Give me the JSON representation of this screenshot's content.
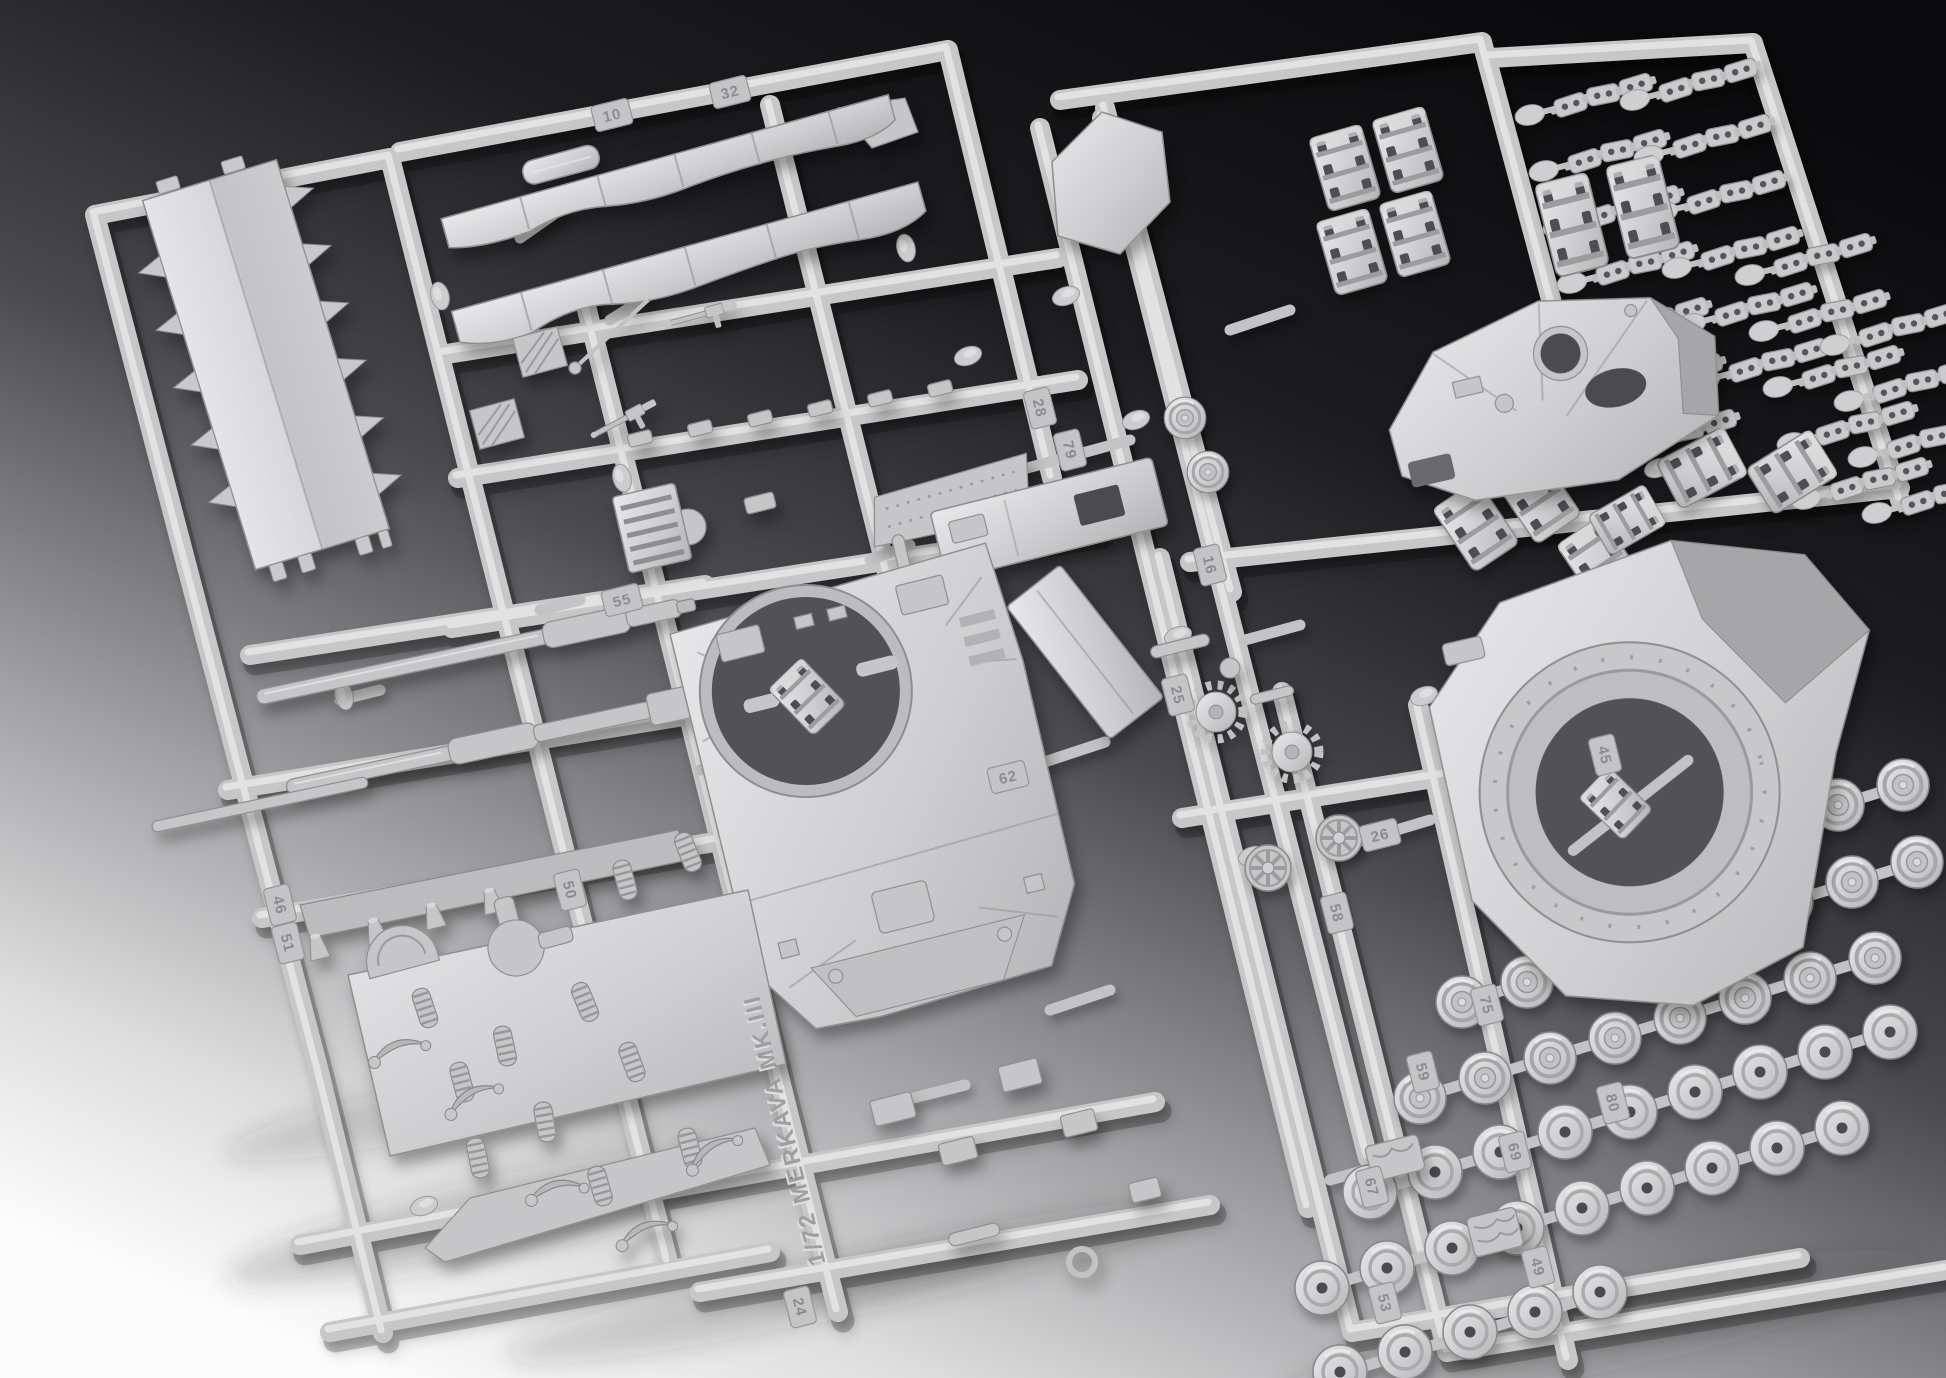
{
  "photo": {
    "subject": "Light grey injection-moulded plastic model kit sprues of a 1/72 armoured-vehicle kit photographed on a dark-to-light studio background",
    "embossed_rail_text": "1/72 MERKAVA MK.III",
    "part_number_tabs": [
      "32",
      "10",
      "28",
      "55",
      "79",
      "16",
      "25",
      "62",
      "26",
      "58",
      "45",
      "75",
      "59",
      "80",
      "69",
      "67",
      "49",
      "53",
      "46",
      "51",
      "50",
      "24"
    ],
    "visible_parts": [
      "spiked hull roof panel",
      "side skirts",
      "upper hull with turret ring opening",
      "turret with hatch openings",
      "turret base plate with ring opening",
      "roof plate",
      "engine deck plate",
      "glacis plate",
      "gun barrels",
      "road wheels",
      "drive sprockets",
      "spoked idler wheels",
      "track link sections",
      "track link chain segments",
      "coil springs",
      "suspension arms",
      "engine grilles",
      "hull side plates",
      "machine gun",
      "antenna"
    ],
    "colors": {
      "background_dark": "#0a0a0c",
      "background_light": "#fbfbfb",
      "plastic_light": "#e8e8ea",
      "plastic_base": "#c8c8ca",
      "plastic_shadow": "#8e8e90",
      "cavity_dark": "#4c4c50",
      "emboss_text": "#9e9ea0"
    }
  }
}
